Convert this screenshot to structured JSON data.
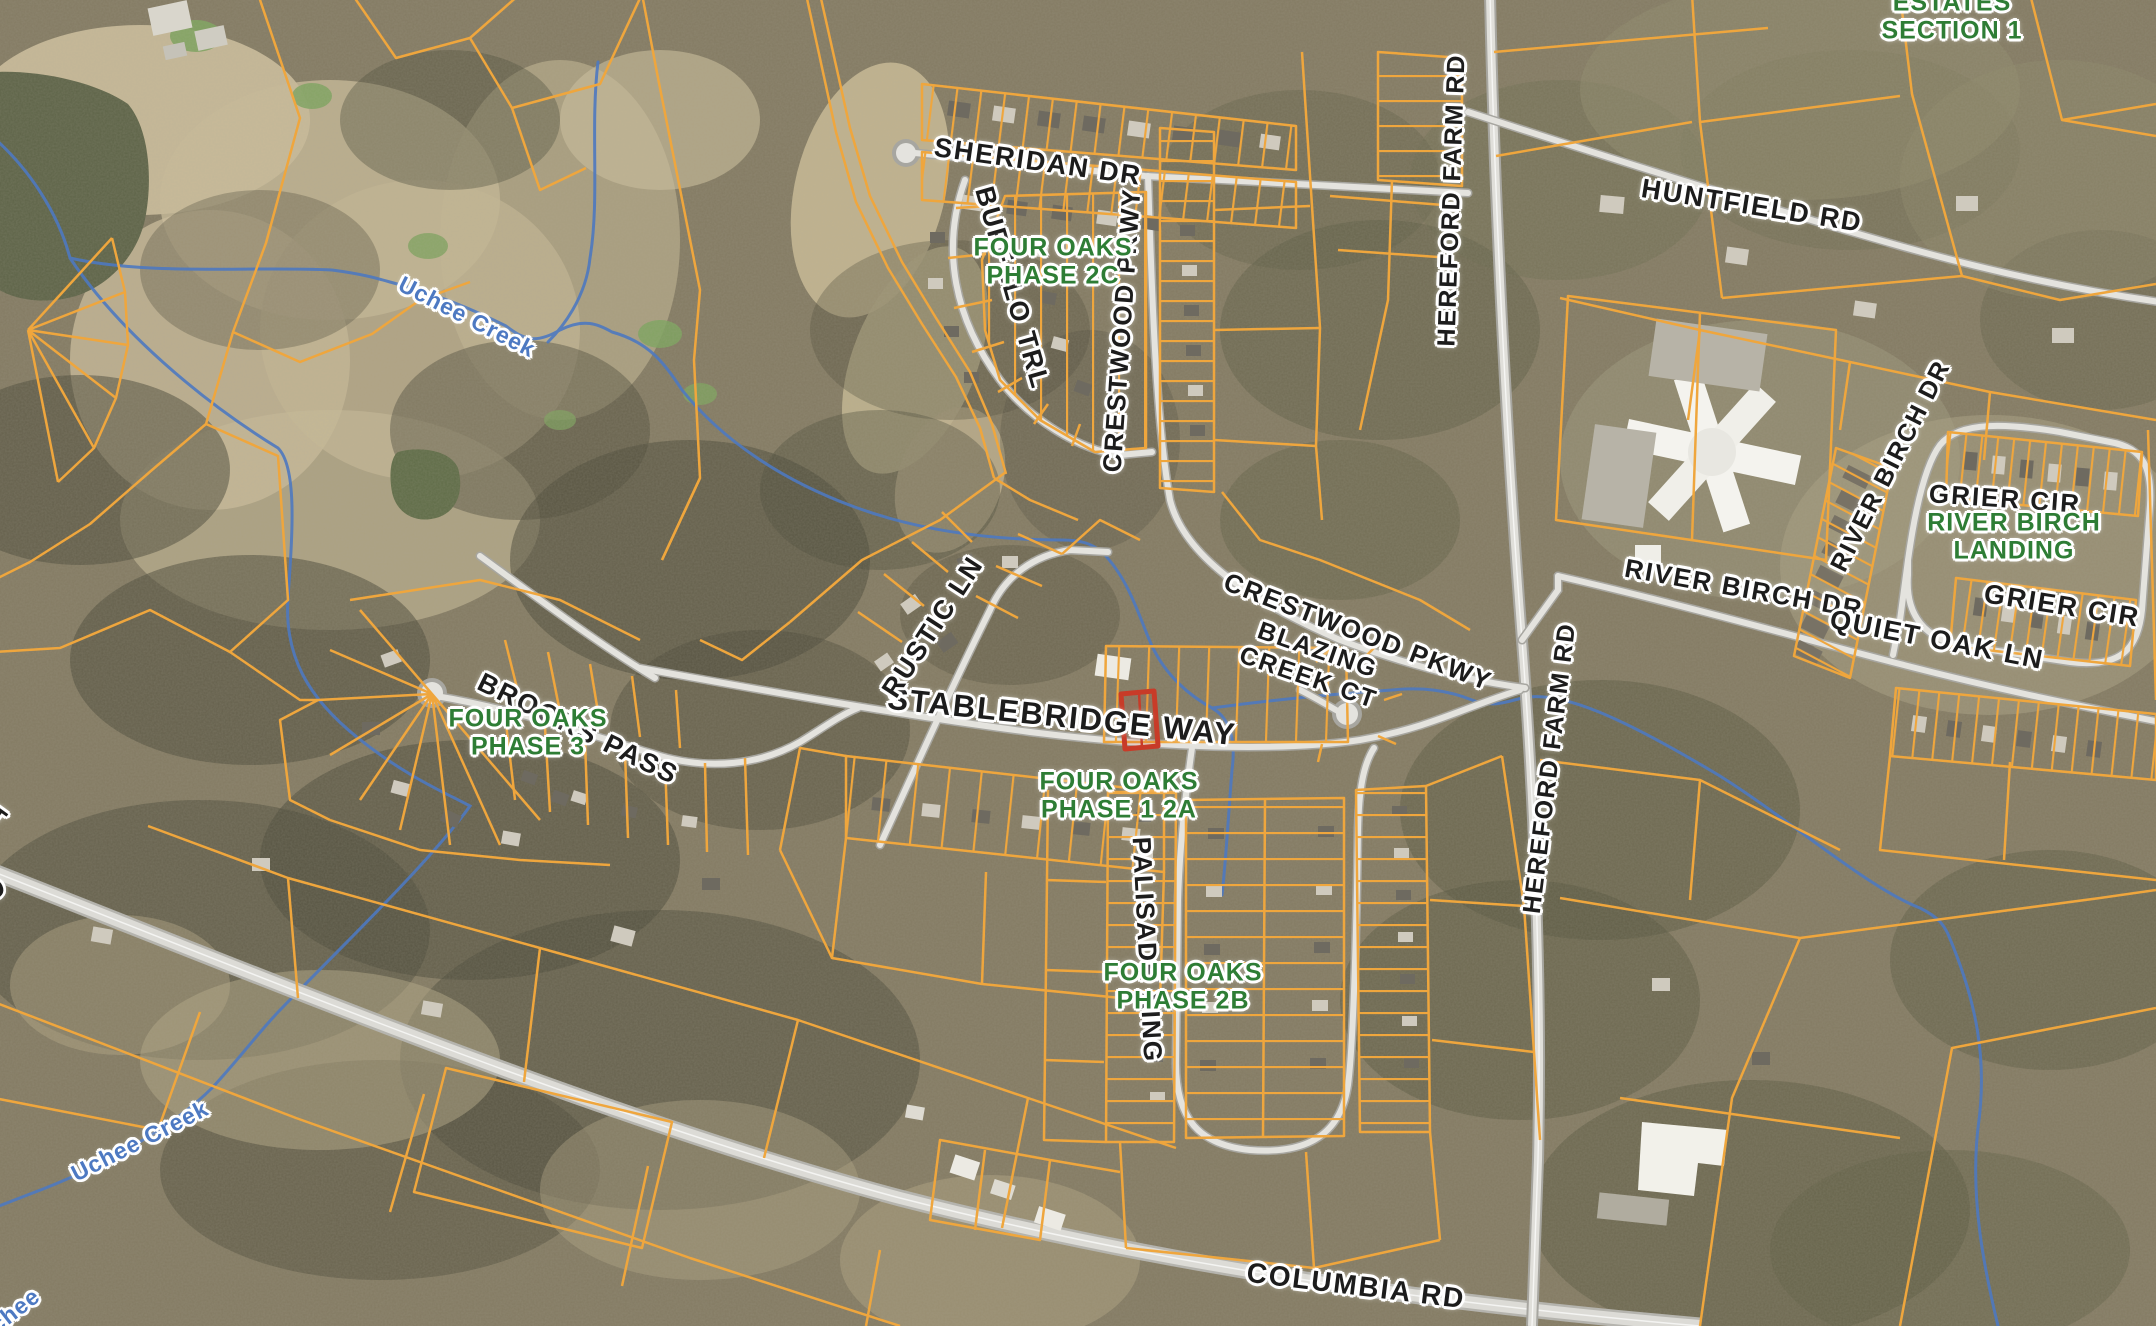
{
  "labels": {
    "road": {
      "sheridan": "SHERIDAN DR",
      "buffalo": "BUFFALO TRL",
      "crestwood_vertical": "CRESTWOOD PKWY",
      "crestwood_diagonal": "CRESTWOOD PKWY",
      "blazing_line1": "BLAZING",
      "blazing_line2": "CREEK CT",
      "stablebridge": "STABLEBRIDGE WAY",
      "rustic": "RUSTIC LN",
      "brooks": "BROOKS PASS",
      "palisade": "PALISADE XING",
      "hereford_north": "HEREFORD FARM RD",
      "hereford_south": "HEREFORD FARM RD",
      "huntfield": "HUNTFIELD RD",
      "river_birch_main": "RIVER BIRCH DR",
      "river_birch_loop": "RIVER BIRCH DR",
      "quiet_oak": "QUIET OAK LN",
      "grier_upper": "GRIER CIR",
      "grier_lower": "GRIER CIR",
      "columbia": "COLUMBIA RD",
      "edge_fragment_ct": "CT",
      "edge_fragment_rd": "RD"
    },
    "subdivision": {
      "estates_line1": "ESTATES",
      "estates_line2": "SECTION 1",
      "phase2c_line1": "FOUR OAKS",
      "phase2c_line2": "PHASE 2C",
      "phase12a_line1": "FOUR OAKS",
      "phase12a_line2": "PHASE 1 2A",
      "phase2b_line1": "FOUR OAKS",
      "phase2b_line2": "PHASE 2B",
      "phase3_line1": "FOUR OAKS",
      "phase3_line2": "PHASE 3",
      "river_birch_landing_line1": "RIVER BIRCH",
      "river_birch_landing_line2": "LANDING"
    },
    "water": {
      "uchee_creek_upper": "Uchee Creek",
      "uchee_creek_lower": "Uchee Creek",
      "uchee_creek_corner": "Uchee"
    }
  },
  "highlight": {
    "selected_parcel": "red-outlined parcel on Stablebridge Way"
  },
  "colors": {
    "parcel_line": "#efa63d",
    "selected_parcel_outline": "#c83b28",
    "road_label_text": "#1c1c1c",
    "subdivision_label_text": "#2e7d35",
    "water_label_text": "#4d79c2",
    "creek_line": "#4e79c0",
    "road_fill": "#e3e2dd",
    "label_halo": "#ffffff"
  }
}
